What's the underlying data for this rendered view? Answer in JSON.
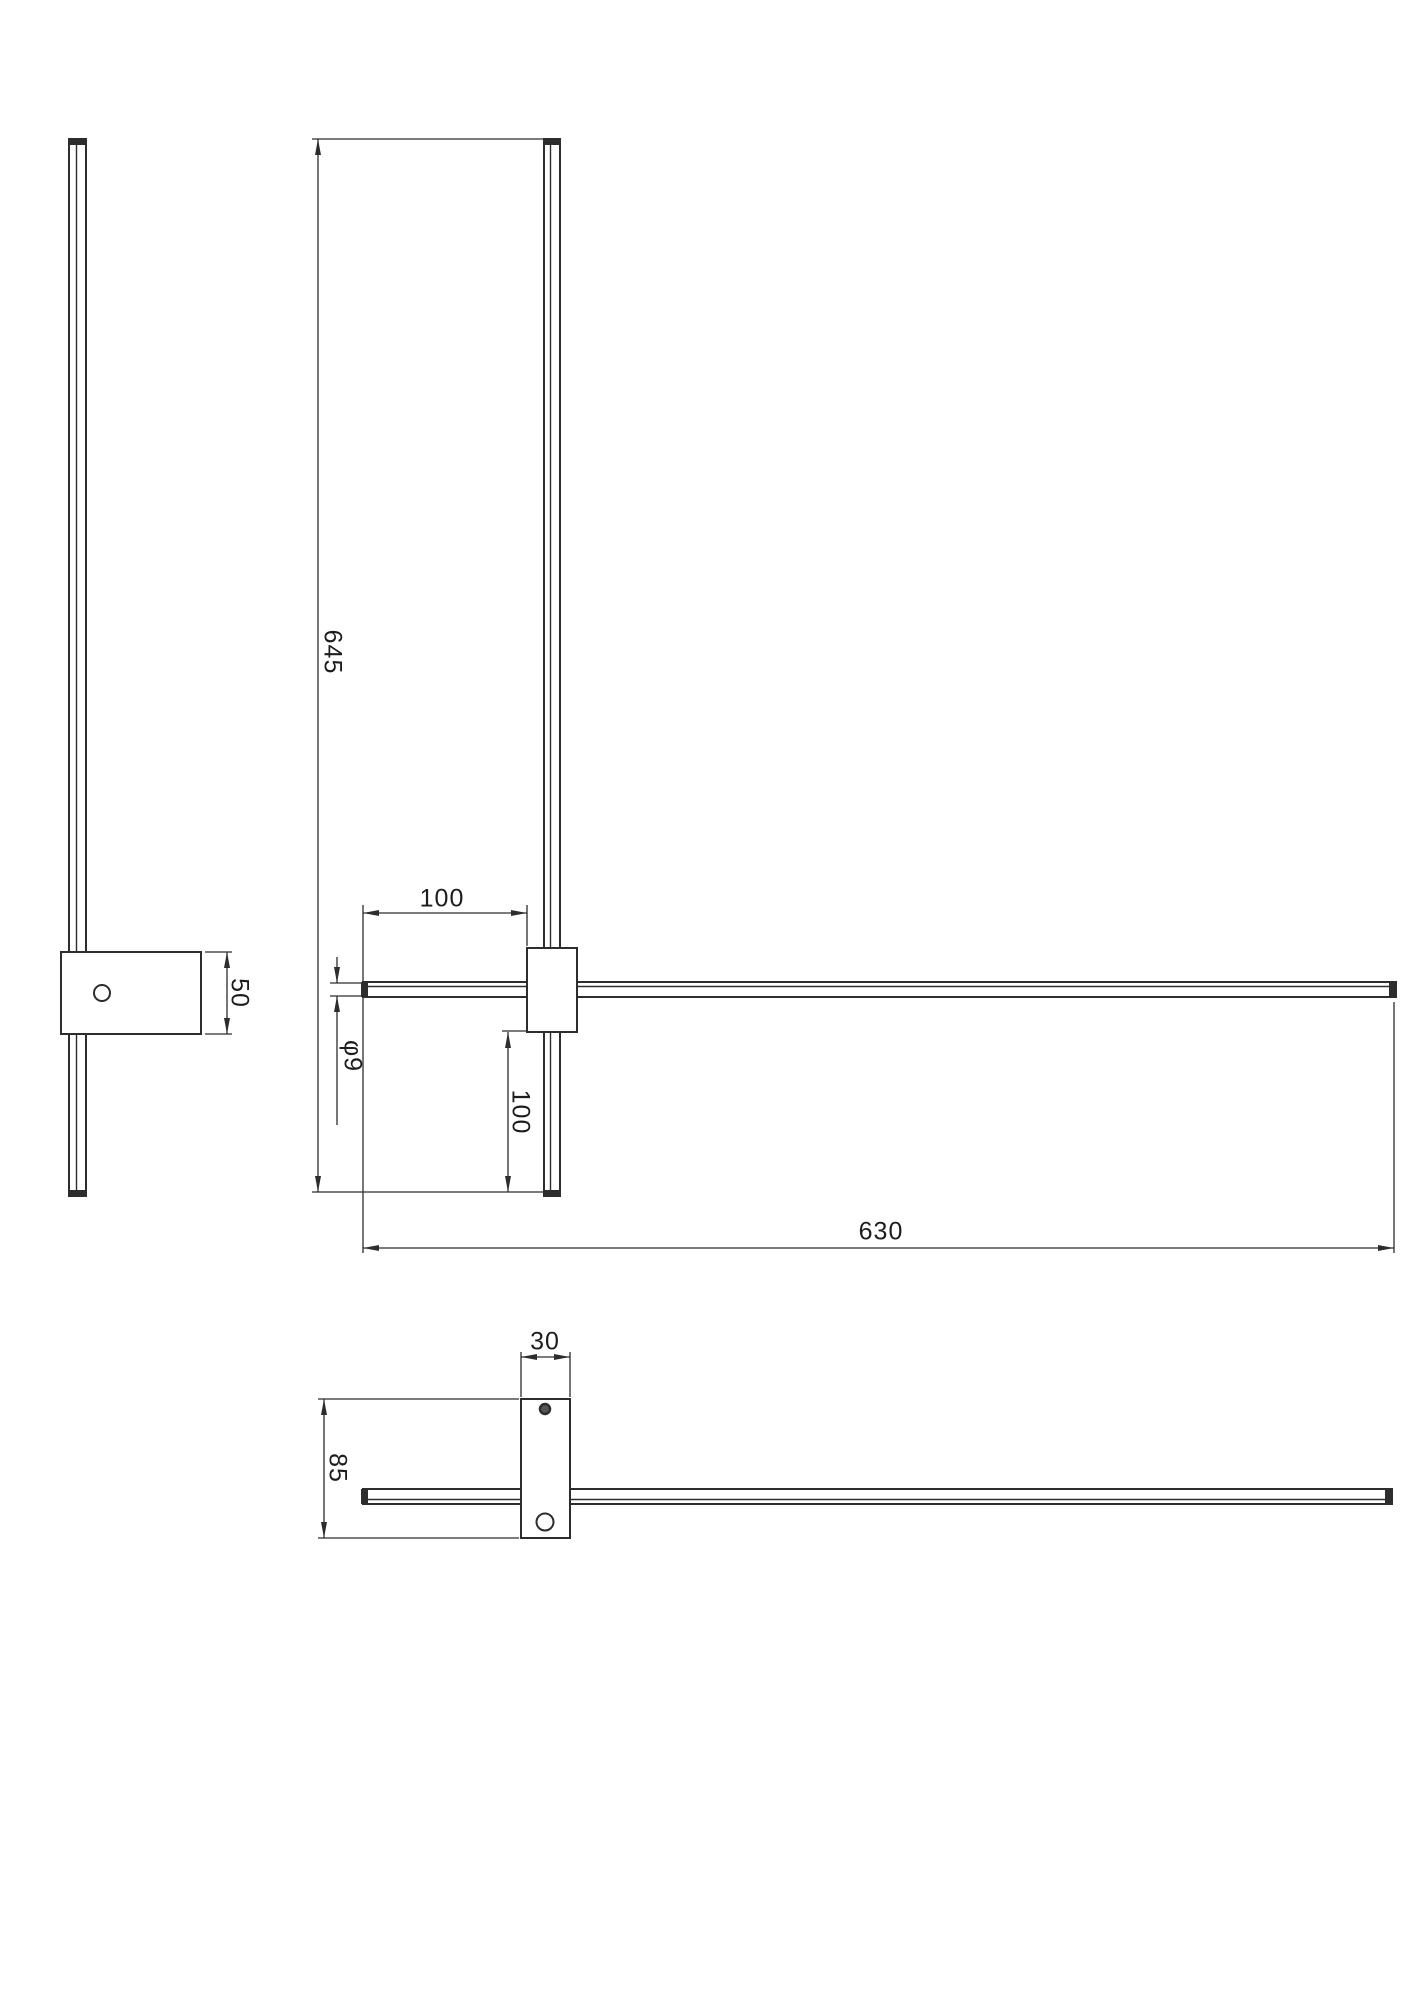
{
  "page": {
    "background": "#ffffff",
    "line_color": "#2d2d2d"
  },
  "views": {
    "side": {
      "dim_plate_height": "50"
    },
    "front": {
      "dim_vertical_bar_length": "645",
      "dim_offset_top": "100",
      "dim_bar_diameter": "φ9",
      "dim_offset_bottom": "100",
      "dim_horizontal_bar_length": "630"
    },
    "bottom": {
      "dim_mount_width": "30",
      "dim_mount_depth": "85"
    }
  }
}
